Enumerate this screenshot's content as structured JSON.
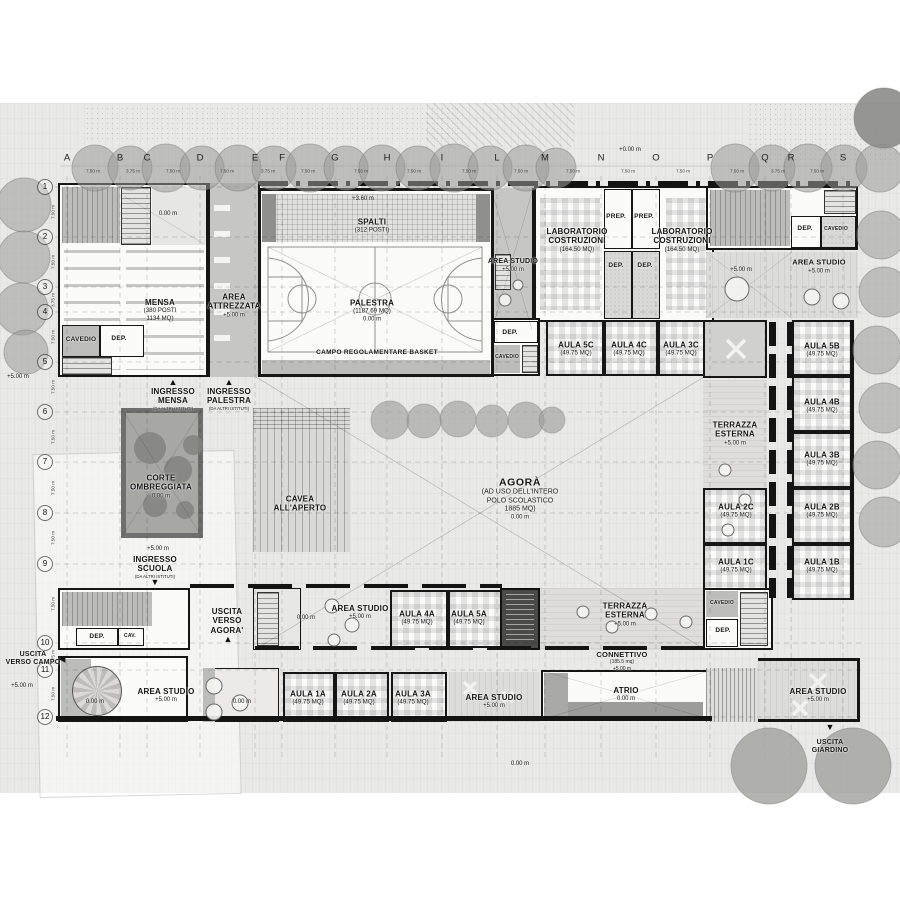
{
  "icons": {
    "arrow_up": "▲",
    "arrow_down": "▼",
    "arrow_left": "◀"
  },
  "grid": {
    "cols": [
      "A",
      "B",
      "C",
      "D",
      "E",
      "F",
      "G",
      "H",
      "I",
      "L",
      "M",
      "N",
      "O",
      "P",
      "Q",
      "R",
      "S"
    ],
    "rows": [
      "1",
      "2",
      "3",
      "4",
      "5",
      "6",
      "7",
      "8",
      "9",
      "10",
      "11",
      "12"
    ],
    "top_dims": [
      "7.50 m",
      "3.75 m",
      "7.50 m",
      "7.50 m",
      "3.75 m",
      "7.50 m",
      "7.50 m",
      "7.50 m",
      "7.50 m",
      "7.50 m",
      "7.50 m",
      "7.50 m",
      "7.50 m",
      "7.50 m",
      "3.75 m",
      "7.50 m"
    ],
    "left_dims": [
      "7.50 m",
      "7.50 m",
      "3.75 m",
      "7.50 m",
      "7.50 m",
      "7.50 m",
      "7.50 m",
      "7.50 m",
      "7.50 m",
      "3.75 m",
      "7.50 m"
    ]
  },
  "annotations": {
    "datum_top": "+0.00 m",
    "left_elev_upper": "+5.00 m",
    "left_elev_lower": "+5.00 m",
    "bottom_datum": "0.00 m"
  },
  "rooms": {
    "mensa": {
      "name": "MENSA",
      "detail": "(380 POSTI\n1134 MQ)"
    },
    "mensa_hall": {
      "elev": "0.00 m"
    },
    "cavedio_mensa": {
      "name": "CAVEDIO"
    },
    "dep_mensa": {
      "name": "DEP."
    },
    "area_attrezzata": {
      "name": "AREA\nATTREZZATA",
      "elev": "+5.00 m"
    },
    "spalti": {
      "name": "SPALTI",
      "detail": "(312 POSTI)"
    },
    "palestra": {
      "name": "PALESTRA",
      "detail": "(1187.69 MQ)",
      "elev": "0.00 m",
      "roof_elev": "+3.60 m",
      "court": "CAMPO REGOLAMENTARE BASKET"
    },
    "area_studio_top": {
      "name": "AREA STUDIO",
      "elev": "+5.00 m"
    },
    "lab_costruzioni_left": {
      "name": "LABORATORIO\nCOSTRUZIONI",
      "detail": "(164.50 MQ)"
    },
    "lab_costruzioni_right": {
      "name": "LABORATORIO\nCOSTRUZIONI",
      "detail": "(164.50 MQ)"
    },
    "prep_left": {
      "name": "PREP."
    },
    "prep_right": {
      "name": "PREP."
    },
    "dep_lab_left": {
      "name": "DEP."
    },
    "dep_lab_right": {
      "name": "DEP."
    },
    "dep_top_right": {
      "name": "DEP."
    },
    "cavedio_top_right": {
      "name": "CAVEDIO"
    },
    "area_studio_top_right": {
      "name": "AREA STUDIO",
      "elev": "+5.00 m",
      "elev_left": "+5.00 m"
    },
    "dep_c": {
      "name": "DEP."
    },
    "cavedio_c": {
      "name": "CAVEDIO"
    },
    "aula_5c": {
      "name": "AULA 5C",
      "detail": "(49.75 MQ)"
    },
    "aula_4c": {
      "name": "AULA 4C",
      "detail": "(49.75 MQ)"
    },
    "aula_3c": {
      "name": "AULA 3C",
      "detail": "(49.75 MQ)"
    },
    "aula_5b": {
      "name": "AULA 5B",
      "detail": "(49.75 MQ)"
    },
    "aula_4b": {
      "name": "AULA 4B",
      "detail": "(49.75 MQ)"
    },
    "aula_3b": {
      "name": "AULA 3B",
      "detail": "(49.75 MQ)"
    },
    "aula_2b": {
      "name": "AULA 2B",
      "detail": "(49.75 MQ)"
    },
    "aula_1b": {
      "name": "AULA 1B",
      "detail": "(49.75 MQ)"
    },
    "aula_2c": {
      "name": "AULA 2C",
      "detail": "(49.75 MQ)"
    },
    "aula_1c": {
      "name": "AULA 1C",
      "detail": "(49.75 MQ)"
    },
    "terrazza_esterna_1": {
      "name": "TERRAZZA\nESTERNA",
      "elev": "+5.00 m"
    },
    "terrazza_esterna_2": {
      "name": "TERRAZZA\nESTERNA",
      "elev": "+5.00 m"
    },
    "ingresso_mensa": {
      "name": "INGRESSO\nMENSA",
      "detail": "(DA ALTRI ISTITUTI)"
    },
    "ingresso_palestra": {
      "name": "INGRESSO\nPALESTRA",
      "detail": "(DA ALTRI ISTITUTI)"
    },
    "ingresso_scuola": {
      "name": "INGRESSO\nSCUOLA",
      "detail": "(DA ALTRI ISTITUTI)",
      "elev": "+5.00 m"
    },
    "corte_ombreggiata": {
      "name": "CORTE\nOMBREGGIATA",
      "elev": "0.00 m"
    },
    "cavea": {
      "name": "CAVEA\nALL'APERTO"
    },
    "agora": {
      "name": "AGORÀ",
      "detail": "(AD USO DELL'INTERO\nPOLO SCOLASTICO\n1885 MQ)",
      "elev": "0.00 m"
    },
    "uscita_agora": {
      "name": "USCITA\nVERSO\nAGORA'"
    },
    "uscita_campo": {
      "name": "USCITA\nVERSO CAMPO"
    },
    "uscita_giardino": {
      "name": "USCITA\nGIARDINO"
    },
    "dep_9_left": {
      "name": "DEP."
    },
    "cav_9_left": {
      "name": "CAV."
    },
    "stair_mid": {
      "elev": "0.00 m"
    },
    "area_studio_mid": {
      "name": "AREA STUDIO",
      "elev": "+5.00 m"
    },
    "aula_4a": {
      "name": "AULA 4A",
      "detail": "(49.75 MQ)"
    },
    "aula_5a": {
      "name": "AULA 5A",
      "detail": "(49.75 MQ)"
    },
    "cavedio_9_right": {
      "name": "CAVEDIO"
    },
    "dep_9_right": {
      "name": "DEP."
    },
    "connettivo": {
      "name": "CONNETTIVO",
      "detail": "(185.5 mq)",
      "elev": "+5.00 m"
    },
    "area_studio_bottom_left": {
      "name": "AREA STUDIO",
      "elev": "+5.00 m"
    },
    "spiral_stair": {
      "elev": "0.00 m"
    },
    "room_bottom_left": {
      "elev": "0.00 m"
    },
    "aula_1a": {
      "name": "AULA 1A",
      "detail": "(49.75 MQ)"
    },
    "aula_2a": {
      "name": "AULA 2A",
      "detail": "(49.75 MQ)"
    },
    "aula_3a": {
      "name": "AULA 3A",
      "detail": "(49.75 MQ)"
    },
    "area_studio_bottom_center": {
      "name": "AREA STUDIO",
      "elev": "+5.00 m"
    },
    "atrio": {
      "name": "ATRIO",
      "elev": "0.00 m"
    },
    "area_studio_bottom_right": {
      "name": "AREA STUDIO",
      "elev": "+5.00 m"
    }
  }
}
